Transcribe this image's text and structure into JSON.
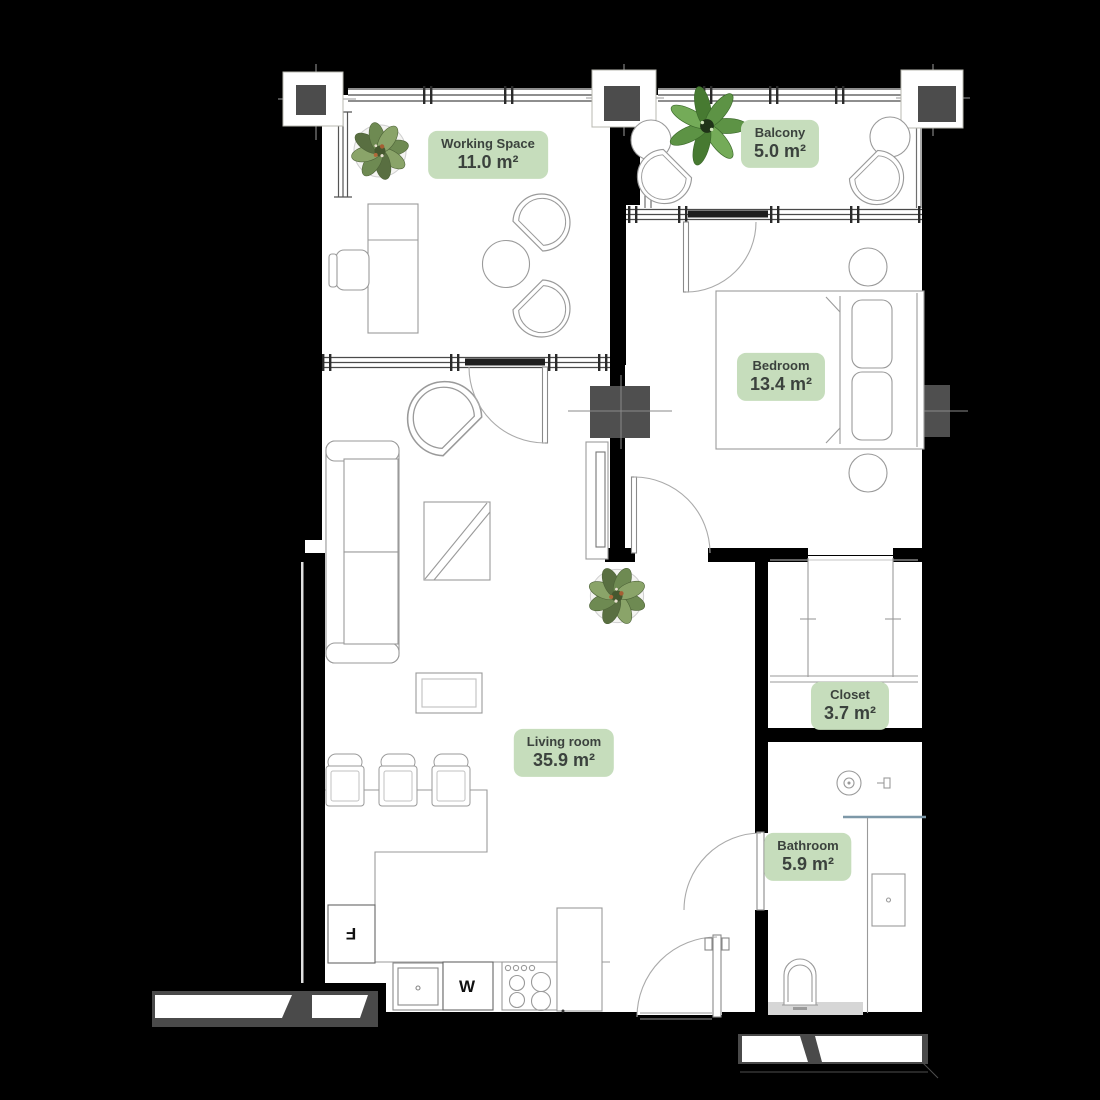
{
  "plan": {
    "type": "apartment-floor-plan",
    "rooms": [
      {
        "id": "working-space",
        "name": "Working Space",
        "area": "11.0 m²"
      },
      {
        "id": "balcony",
        "name": "Balcony",
        "area": "5.0 m²"
      },
      {
        "id": "bedroom",
        "name": "Bedroom",
        "area": "13.4 m²"
      },
      {
        "id": "living-room",
        "name": "Living room",
        "area": "35.9 m²"
      },
      {
        "id": "closet",
        "name": "Closet",
        "area": "3.7 m²"
      },
      {
        "id": "bathroom",
        "name": "Bathroom",
        "area": "5.9 m²"
      }
    ],
    "appliances": {
      "fridge_label": "F",
      "washer_label": "W"
    }
  },
  "style": {
    "background": "#000000",
    "floor": "#ffffff",
    "wall": "#000000",
    "label_bg": "#c6ddbc",
    "label_text": "#3b423d",
    "column_gray": "#4f4f4f",
    "furniture_line": "#9a9a9a",
    "glass_blue": "#7d98a8",
    "plant_green": "#6e8a52",
    "plant_green_light": "#8aa469",
    "monstera_green": "#5d9345"
  }
}
